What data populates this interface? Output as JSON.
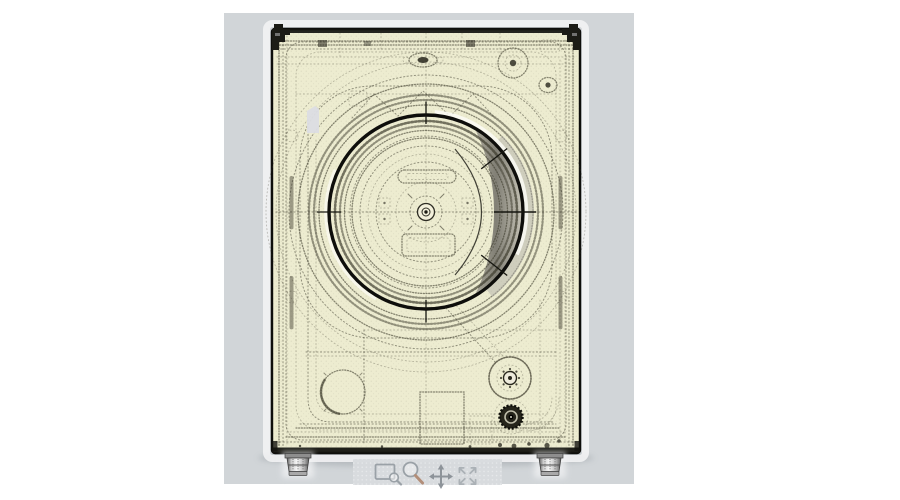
{
  "drawing": {
    "subject": "washing-machine-front-view-technical-wireframe"
  },
  "colors": {
    "page-bg": "#ffffff",
    "viewport-bg": "#d1d5d8",
    "body-fill": "#edecd0",
    "ink": "#3a382a",
    "ink-dark": "#26251b",
    "door-ring": "#0e0e0b",
    "highlight": "#fcfcf6",
    "crescent-dark": "#75736b",
    "crescent-mid": "#a19e92",
    "crescent-light": "#c6c3b8",
    "sticker": "#dcdde3",
    "shadow": "#8f959b",
    "toolbar-bg": "#d8dbde",
    "toolbar-dot": "#e9ebed",
    "icon": "#9aa1a7",
    "icon-strong": "#8d9399",
    "icon-soft": "#abb1b6",
    "zoom-handle": "#b28e79",
    "foot-light": "#f6f6f6",
    "foot-dark": "#5f5f5f"
  },
  "toolbar": {
    "tools": [
      {
        "icon": "zoom-region-icon"
      },
      {
        "icon": "magnifier-icon"
      },
      {
        "icon": "pan-icon"
      },
      {
        "icon": "fit-view-icon"
      }
    ]
  }
}
